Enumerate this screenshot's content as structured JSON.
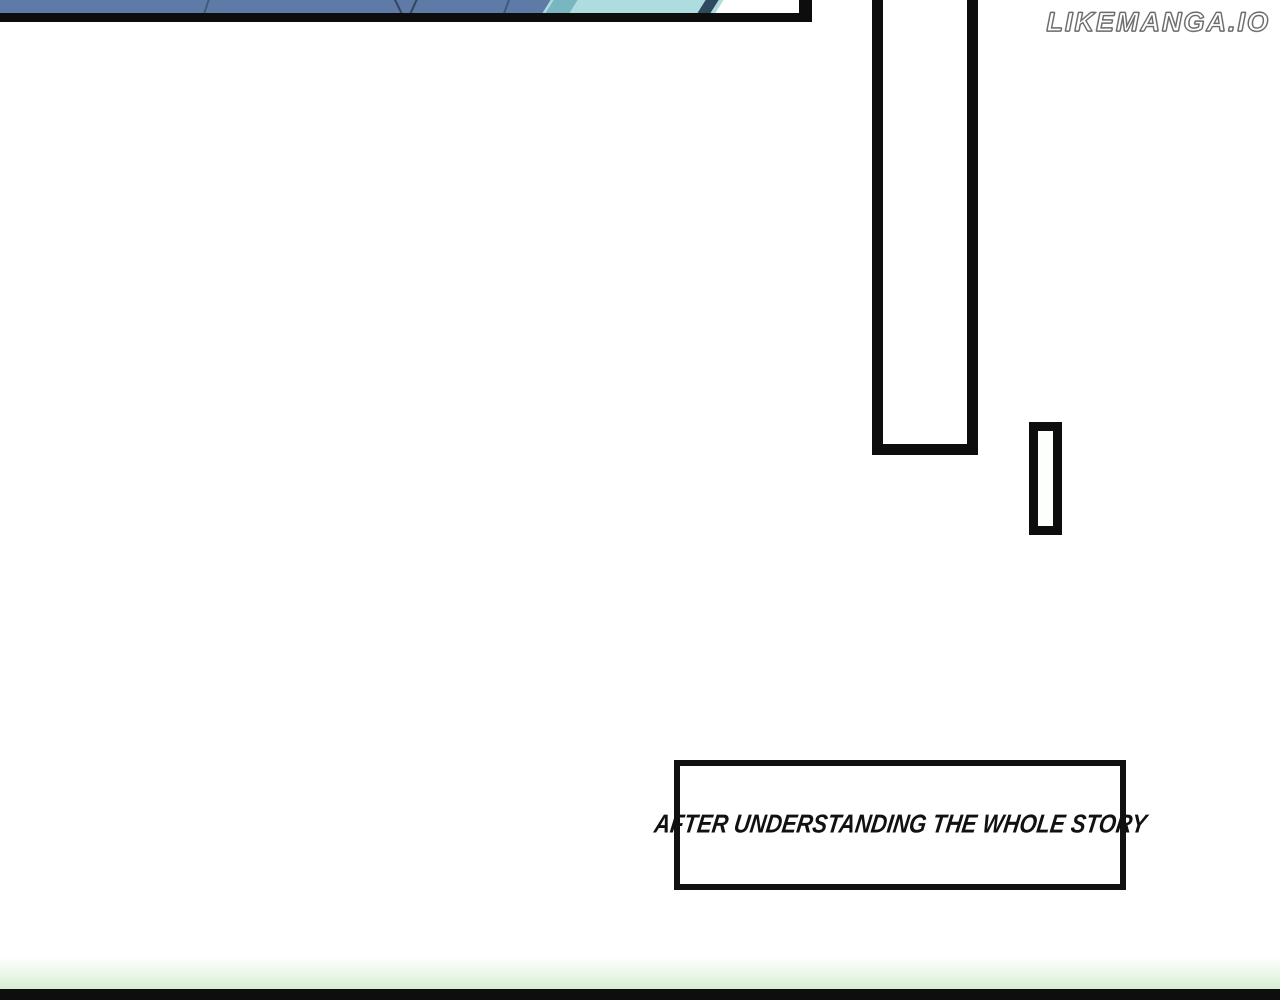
{
  "page": {
    "type": "manga-reader-page",
    "width_px": 1280,
    "height_px": 1000,
    "background_color": "#ffffff"
  },
  "watermark": {
    "text": "LIKEMANGA.IO",
    "fill_color": "#ffffff",
    "outline_color": "#6b6b6b"
  },
  "caption": {
    "text": "AFTER UNDERSTANDING THE WHOLE STORY",
    "text_color": "#111111",
    "box_fill": "#ffffff",
    "box_border_color": "#111111"
  },
  "panels": {
    "top_left_art": {
      "description": "bottom strip of a cropped manga panel",
      "colors": {
        "slate_blue": "#5d7ba6",
        "dark_navy_line": "#2b3c55",
        "light_teal": "#aedde0",
        "mid_teal": "#79b7c0",
        "white_wedge": "#ffffff",
        "border_black": "#0d0d0d"
      }
    },
    "tall_rect": {
      "description": "tall empty bordered panel cut off at top",
      "fill": "#ffffff",
      "border_color": "#0d0d0d"
    },
    "small_rect": {
      "description": "small vertical bordered bar",
      "fill": "#fdfffd",
      "border_color": "#0d0d0d"
    },
    "next_panel_edge": {
      "description": "green glow top edge of next panel at page bottom",
      "glow_color": "#d4efd2",
      "border_color": "#0c0f0c"
    }
  }
}
